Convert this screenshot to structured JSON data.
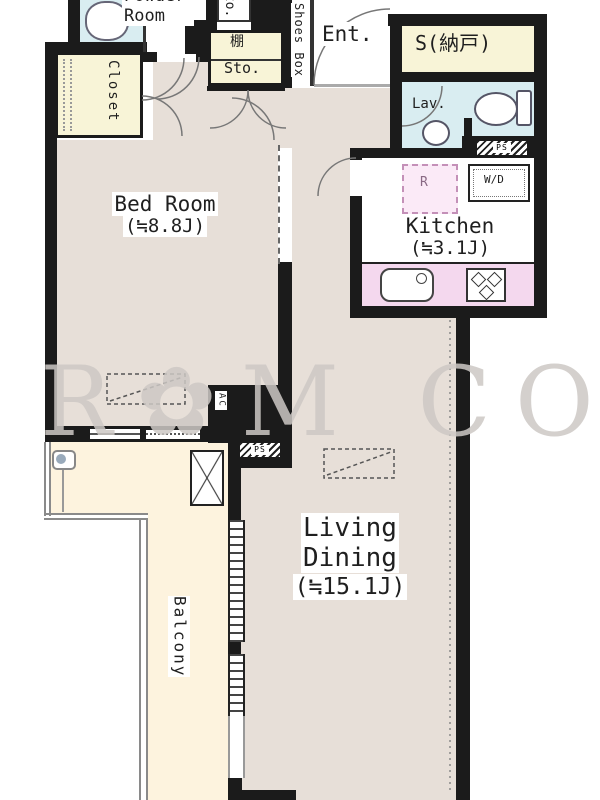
{
  "colors": {
    "wall": "#1b1b1b",
    "floor": "#e7dfd8",
    "balcony": "#fdf3de",
    "water": "#d9edf1",
    "storage": "#f8f4d7",
    "counter": "#f4d8ee",
    "fridge_bg": "#fbeaf7",
    "fridge_line": "#c490b8"
  },
  "watermark": {
    "text": "R✿M COR"
  },
  "rooms": {
    "powder_room": {
      "label": "Powder Room"
    },
    "closet": {
      "label": "Closet"
    },
    "shelf": {
      "label": "棚"
    },
    "storage": {
      "label": "Sto."
    },
    "storage_top": {
      "label": "Sto."
    },
    "shoes_box": {
      "label": "Shoes Box"
    },
    "entrance": {
      "label": "Ent."
    },
    "service_room": {
      "label": "S(納戸)"
    },
    "lavatory": {
      "label": "Lav."
    },
    "kitchen": {
      "label": "Kitchen",
      "size": "(≒3.1J)"
    },
    "bedroom": {
      "label": "Bed Room",
      "size": "(≒8.8J)"
    },
    "living_dining": {
      "line1": "Living",
      "line2": "Dining",
      "size": "(≒15.1J)"
    },
    "balcony": {
      "label": "Balcony"
    }
  },
  "fixtures": {
    "washer_dryer": {
      "label": "W/D"
    },
    "refrigerator": {
      "label": "R"
    },
    "air_conditioner": {
      "label": "AC"
    },
    "pipe_space_upper": {
      "label": "PS"
    },
    "pipe_space_lower": {
      "label": "PS"
    }
  }
}
